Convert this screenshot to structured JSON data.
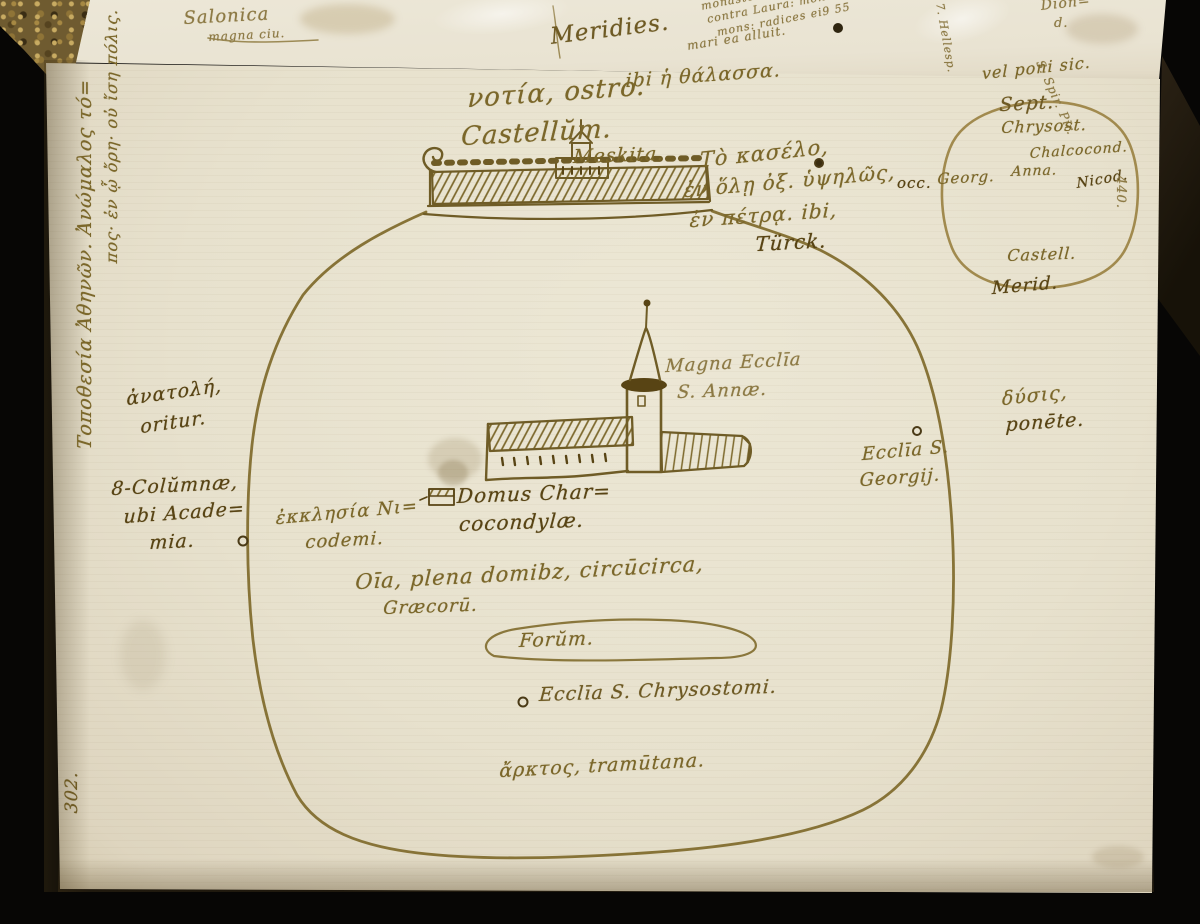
{
  "scene": {
    "description": "Photograph of an open early-modern manuscript notebook showing a hand-drawn ink sketch map of Athens with Greek and Latin annotations",
    "colors": {
      "background": "#070605",
      "page": "#e7e1cd",
      "ink": "#7b672a",
      "ink_dark": "#584414",
      "spine_gold": "#6f5b30"
    }
  },
  "previous_page": {
    "fragments": {
      "salonica": "Salonica",
      "salonica2": "magna ciu.",
      "block1": "monasteria Latinoru ibi 2.",
      "block2": "contra Laura: monasteria.",
      "block3": "mons: radices ei9 55",
      "block4": "mari ea alluit.",
      "meridies": "Meridies.",
      "corner1": "Dion=",
      "corner2": "d.",
      "rot1": "S. Spir. Pir.",
      "rot2": "7. Hellesp."
    }
  },
  "map": {
    "labels": {
      "notia": "νοτία, ostro.",
      "thalassa": "ibi ἡ θάλασσα.",
      "castellum": "Castellŭm.",
      "meskita": "Meskita.",
      "kastro1": "Τὸ κασέλο,",
      "kastro2": "ἐν ὅλῃ ὀξ. ὑψηλῶς,",
      "kastro3": "ἐν πέτρᾳ. ibi,",
      "kastro4": "Türck.",
      "occ": "occ.",
      "vel_poni": "vel poni sic.",
      "sept": "Sept.",
      "chrysost": "Chrysost.",
      "chalcocond": "Chalcocond.",
      "anna": "Anna.",
      "georg": "Georg.",
      "nicod": "Nicod.",
      "castell": "Castell.",
      "merid": "Merid.",
      "folio_right": "440.",
      "title1": "Τοποθεσία Ἀθηνῶν. Ἀνώμαλος τό=",
      "title2": "πος· ἐν ᾧ ὄρη· οὐ ἴση πόλις.",
      "anatole1": "ἀνατολή,",
      "anatole2": "oritur.",
      "columnae1": "8-Colŭmnæ,",
      "columnae2": "ubi Acade=",
      "columnae3": "mia.",
      "nicodemi1": "ἐκκλησία Νι=",
      "nicodemi2": "codemi.",
      "magna1": "Magna Ecclīa",
      "magna2": "S. Annæ.",
      "domus1": "Domus Char=",
      "domus2": "cocondylæ.",
      "omnia1": "Oīa, plena domibz, circūcirca,",
      "omnia2": "Græcorū.",
      "forum": "Forŭm.",
      "chrysostomi": "Ecclīa S. Chrysostomi.",
      "dysis1": "δύσις,",
      "dysis2": "ponēte.",
      "georgii1": "Ecclīa S.",
      "georgii2": "Georgij.",
      "arktos": "ἄρκτος, tramūtana.",
      "folio_left": "302."
    },
    "drawings": [
      "city-wall-outline",
      "castle-on-hill",
      "great-church-with-tower",
      "house-of-chalcocondyles",
      "forum-outline",
      "compass-circle",
      "location-dots"
    ]
  }
}
